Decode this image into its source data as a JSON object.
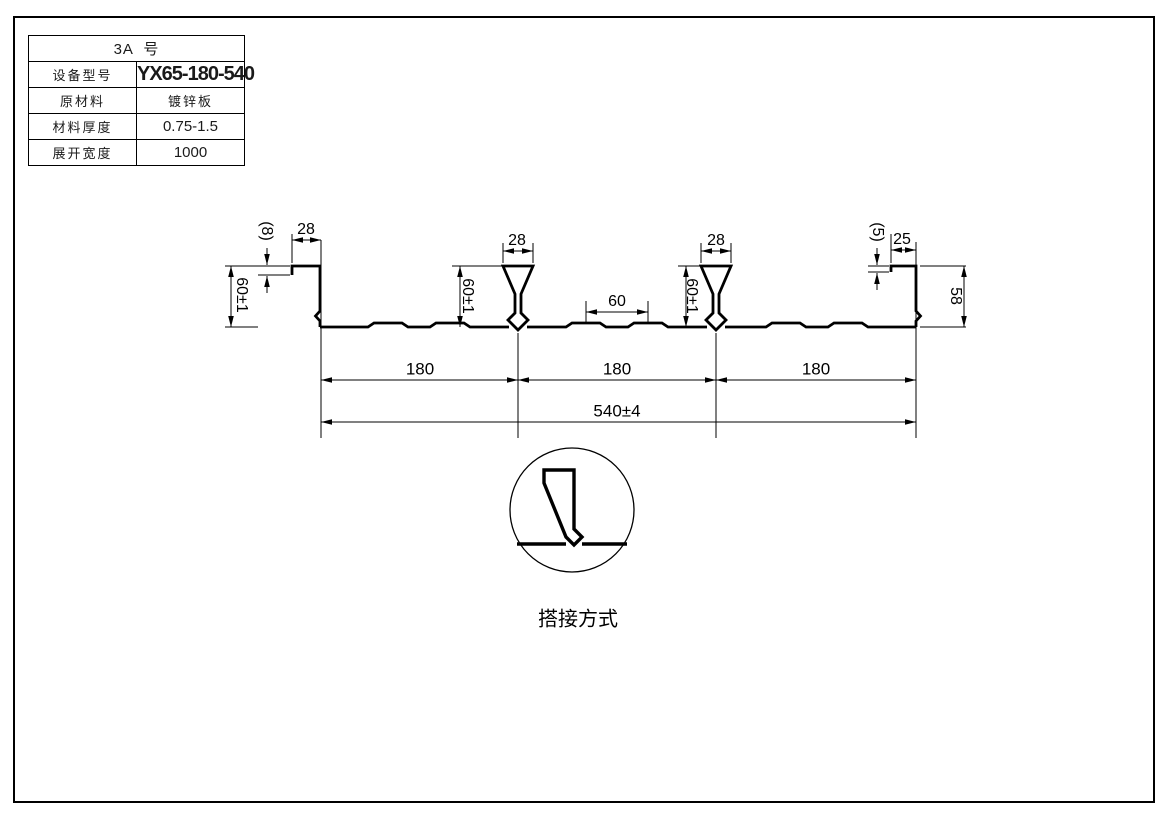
{
  "table": {
    "title": "3A  号",
    "rows": [
      {
        "label": "设备型号",
        "value": "YX65-180-540"
      },
      {
        "label": "原材料",
        "value": "镀锌板"
      },
      {
        "label": "材料厚度",
        "value": "0.75-1.5"
      },
      {
        "label": "展开宽度",
        "value": "1000"
      }
    ]
  },
  "drawing": {
    "dims": {
      "left_flange_width": "28",
      "left_lip": "(8)",
      "left_height": "60±1",
      "rib1_width": "28",
      "rib1_height": "60±1",
      "mid_flat": "60",
      "rib2_width": "28",
      "rib2_height": "60±1",
      "right_lip": "(5)",
      "right_flange_width": "25",
      "right_height": "58",
      "pitch1": "180",
      "pitch2": "180",
      "pitch3": "180",
      "overall_width": "540±4"
    },
    "detail_label": "搭接方式"
  },
  "colors": {
    "line": "#000000",
    "background": "#ffffff"
  }
}
